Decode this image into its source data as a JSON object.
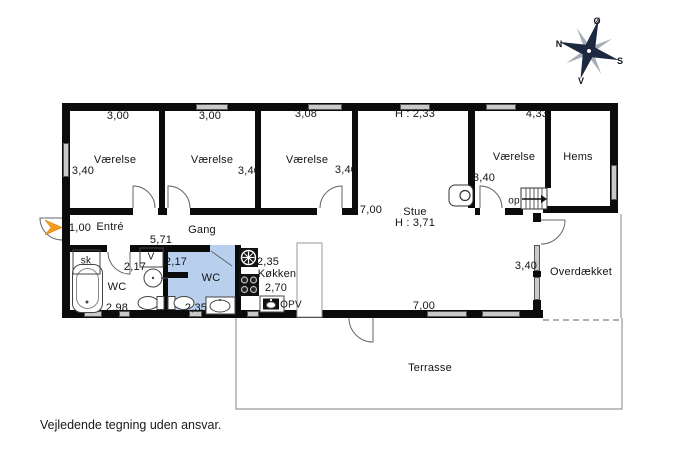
{
  "compass": {
    "north": "N",
    "east": "Ø",
    "south": "S",
    "west": "V"
  },
  "rooms": {
    "vaerelse1": {
      "name": "Værelse",
      "width": "3,00",
      "depth": "3,40"
    },
    "vaerelse2": {
      "name": "Værelse",
      "width": "3,00",
      "depth": "3,40"
    },
    "vaerelse3": {
      "name": "Værelse",
      "width": "3,08",
      "depth": "3,40"
    },
    "vaerelse4": {
      "name": "Værelse",
      "width": "4,33",
      "depth": "3,40"
    },
    "hems": {
      "name": "Hems"
    },
    "stue": {
      "name": "Stue",
      "ceiling_height": "H : 3,71",
      "ceiling_height_low": "H : 2,33",
      "width": "7,00",
      "width_bottom": "7,00"
    },
    "entre": {
      "name": "Entré",
      "dim": "1,00"
    },
    "gang": {
      "name": "Gang",
      "length": "5,71"
    },
    "badevaerelse": {
      "name": "WC",
      "width": "2,17",
      "depth": "2,98"
    },
    "wc": {
      "name": "WC",
      "width": "2,17",
      "depth": "2,35"
    },
    "koekken": {
      "name": "Køkken",
      "width": "2,35",
      "depth": "2,70"
    },
    "overdaekket": {
      "name": "Overdækket",
      "depth": "3,40"
    },
    "terrasse": {
      "name": "Terrasse"
    }
  },
  "annotations": {
    "stairs_up": "op",
    "closet": "sk",
    "washer": "V",
    "dishwasher": "OPV"
  },
  "footer": {
    "disclaimer": "Vejledende tegning uden ansvar."
  },
  "colors": {
    "wall": "#0b0b0b",
    "window_fill": "#c9c9c9",
    "wc_highlight": "#b9cfee",
    "entrance_arrow": "#f49b1f",
    "compass": "#1d2940"
  }
}
